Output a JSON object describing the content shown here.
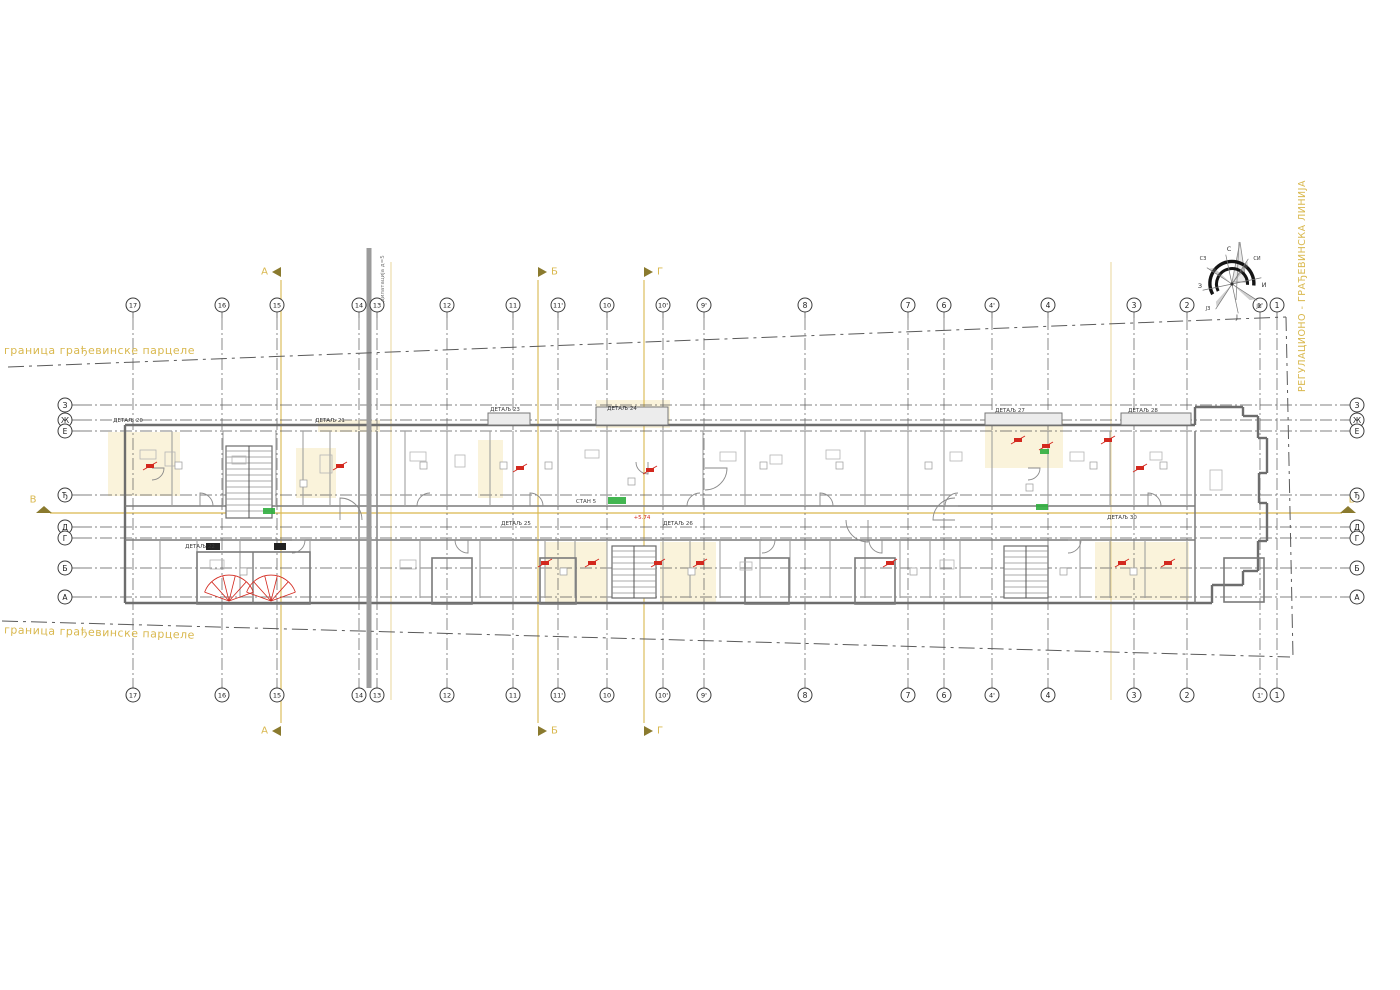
{
  "colors": {
    "section_yellow": "#d9b84e",
    "olive": "#8a7a2e",
    "red": "#d3281e",
    "green": "#2fae3e",
    "grid": "#5a5a5a",
    "wall": "#6d6d6d",
    "partition": "#a0a0a0",
    "dilatation_gray": "#9b9b9b",
    "pale_yellow_fill": "rgba(232,200,90,0.22)"
  },
  "axes": {
    "columns": [
      {
        "label": "17",
        "x": 133
      },
      {
        "label": "16",
        "x": 222
      },
      {
        "label": "15",
        "x": 277
      },
      {
        "label": "14",
        "x": 359
      },
      {
        "label": "13",
        "x": 377
      },
      {
        "label": "12",
        "x": 447
      },
      {
        "label": "11",
        "x": 513
      },
      {
        "label": "11'",
        "x": 558
      },
      {
        "label": "10",
        "x": 607
      },
      {
        "label": "10'",
        "x": 663
      },
      {
        "label": "9'",
        "x": 704
      },
      {
        "label": "8",
        "x": 805
      },
      {
        "label": "7",
        "x": 908
      },
      {
        "label": "6",
        "x": 944
      },
      {
        "label": "4'",
        "x": 992
      },
      {
        "label": "4",
        "x": 1048
      },
      {
        "label": "3",
        "x": 1134
      },
      {
        "label": "2",
        "x": 1187
      },
      {
        "label": "1'",
        "x": 1260
      },
      {
        "label": "1",
        "x": 1277
      }
    ],
    "rows": [
      {
        "label": "З",
        "y": 405
      },
      {
        "label": "Ж",
        "y": 420
      },
      {
        "label": "Е",
        "y": 431
      },
      {
        "label": "Ђ",
        "y": 495
      },
      {
        "label": "Д",
        "y": 527
      },
      {
        "label": "Г",
        "y": 538
      },
      {
        "label": "Б",
        "y": 568
      },
      {
        "label": "А",
        "y": 597
      }
    ],
    "top_bubble_y": 305,
    "bottom_bubble_y": 695,
    "left_bubble_x": 65,
    "right_bubble_x": 1357,
    "v_line_top": 318,
    "v_line_bottom": 686,
    "h_line_left": 80,
    "h_line_right": 1344
  },
  "sections": {
    "vertical": [
      {
        "label": "А",
        "dir": "left",
        "line_x": 281,
        "top_y": 272,
        "bottom_y": 731
      },
      {
        "label": "Б",
        "dir": "right",
        "line_x": 538,
        "top_y": 272,
        "bottom_y": 731
      },
      {
        "label": "Г",
        "dir": "right",
        "line_x": 644,
        "top_y": 272,
        "bottom_y": 731
      }
    ],
    "horizontal": {
      "label": "В",
      "line_y": 513,
      "letter_y": 500,
      "left_letter_x": 33,
      "right_letter_x": 1352
    }
  },
  "boundary": {
    "top_text": "граница грађевинске парцеле",
    "bottom_text": "граница грађевинске парцеле",
    "right_text": "РЕГУЛАЦИОНО - ГРАЂЕВИНСКА ЛИНИЈА"
  },
  "dilatation": {
    "text": "дилатација д=5"
  },
  "details": [
    {
      "label": "ДЕТАЉ 20",
      "x": 128,
      "y": 421
    },
    {
      "label": "ДЕТАЉ 21",
      "x": 330,
      "y": 421
    },
    {
      "label": "ДЕТАЉ 23",
      "x": 505,
      "y": 410
    },
    {
      "label": "ДЕТАЉ 24",
      "x": 622,
      "y": 409
    },
    {
      "label": "ДЕТАЉ 27",
      "x": 1010,
      "y": 411
    },
    {
      "label": "ДЕТАЉ 28",
      "x": 1143,
      "y": 411
    },
    {
      "label": "ДЕТАЉ 22",
      "x": 200,
      "y": 547
    },
    {
      "label": "ДЕТАЉ 25",
      "x": 516,
      "y": 524
    },
    {
      "label": "ДЕТАЉ 26",
      "x": 678,
      "y": 524
    },
    {
      "label": "ДЕТАЉ 30",
      "x": 1122,
      "y": 518
    }
  ],
  "plan_labels": [
    {
      "text": "СТАН 5",
      "x": 586,
      "y": 502,
      "color": "#444"
    },
    {
      "text": "+5.74",
      "x": 642,
      "y": 518,
      "color": "#d3281e"
    }
  ],
  "compass": {
    "n": "С",
    "ne": "СИ",
    "e": "И",
    "se": "ЈИ",
    "s": "Ј",
    "sw": "ЈЗ",
    "w": "З",
    "nw": "СЗ"
  }
}
